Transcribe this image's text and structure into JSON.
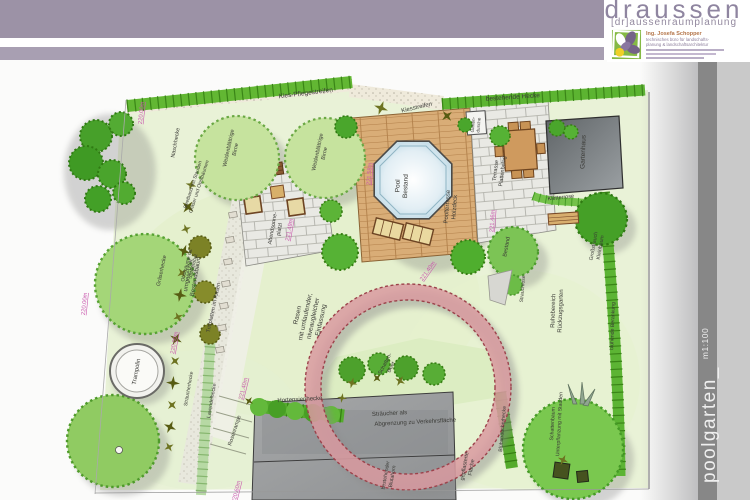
{
  "header": {
    "brand": "draussen",
    "brand_sub": "[dr]aussenraumplanung",
    "card": {
      "name": "Ing. Josefa Schopper",
      "tagline1": "technisches büro für landschafts-",
      "tagline2": "planung & landschaftsarchitektur"
    }
  },
  "sidebar": {
    "project": "poolgarten_",
    "scale": "m1:100"
  },
  "plan": {
    "labels": {
      "kies_pflegestreifen": "Kies-Pflegestreifen",
      "kiesstreifen": "Kiesstreifen",
      "bestehende_hecke": "bestehende Hecke",
      "naschhecke": "Naschhecke",
      "weidenbirne": [
        "Weidenblättrige",
        "Birne"
      ],
      "umgesetzter_baum": [
        "umgesetzter",
        "Bestandsbaum"
      ],
      "beetband": [
        "Beetband mit Stauden",
        "Gräser und Obstbäumen"
      ],
      "graeserhecke": "Gräserhecke",
      "obstbaeume": [
        "Obstbäume od.",
        "Spalierobst"
      ],
      "trittplatten": "Trittplatten im Rasen",
      "abendsonne": [
        "Abendsonne-",
        "platzl"
      ],
      "pool": [
        "Pool",
        "Bestand"
      ],
      "poolterrasse": [
        "Poolterrasse",
        "Holzdeck"
      ],
      "gartendusche": [
        "Garten-",
        "dusche"
      ],
      "terrasse": [
        "Terrasse",
        "Plattenbelag"
      ],
      "gartenhaus": "Gartenhaus",
      "kletterrose": "Kletterrose",
      "bestand": "Bestand",
      "grossstrauch": [
        "Großstrauch",
        "Kleinbaum"
      ],
      "ruhebereich": [
        "Ruhebereich",
        "Rückzugsgarten"
      ],
      "strauchrose": "Strauchrose",
      "berankung": "blühende Berankung",
      "rasen": [
        "Rasen",
        "mit umlaufender,",
        "niveaugleicher",
        "Einfassung"
      ],
      "schattenbeet": [
        "Schatten-",
        "Beet"
      ],
      "hortensienhecke": "Hortensienhecke",
      "straeucher_abgrenzung": [
        "Sträucher als",
        "Abgrenzung zu Verkehrsfläche"
      ],
      "gepflasterte": [
        "gepflasterte",
        "Fläche"
      ],
      "blutahorn": [
        "bestehender",
        "Blutahorn"
      ],
      "bluehstraeucherhecke": "Blühsträucherhecke",
      "schattenbaum": [
        "Schattenbaum",
        "Unterpflanzung mit Stauden"
      ],
      "trampolin": "Trampolin",
      "straeucherhecke": "Sträucherhecke",
      "lavendelhecke": "Lavendelhecke",
      "rosenrampe": "Rosenrampe"
    },
    "measurements": {
      "m220": "220.00m",
      "m22140": "221.40m",
      "m22158": "221.58m",
      "m22149": "221.49m",
      "m22146": "221.46m",
      "m22060": "220.60m"
    },
    "colors": {
      "band_purple": "#9c92a6",
      "brand_text": "#8f85a0",
      "pink_measure": "#c957ad",
      "hedge_green": "#5cb431",
      "lawn_green": "#e9f2d7",
      "deck_wood": "#d9ad77",
      "ring_red": "#d99aa0",
      "sidebar_dark": "#878787",
      "sidebar_light": "#c9c9c9",
      "logo_green": "#85b944",
      "logo_purple": "#756388",
      "logo_yellow": "#f0d027"
    }
  }
}
